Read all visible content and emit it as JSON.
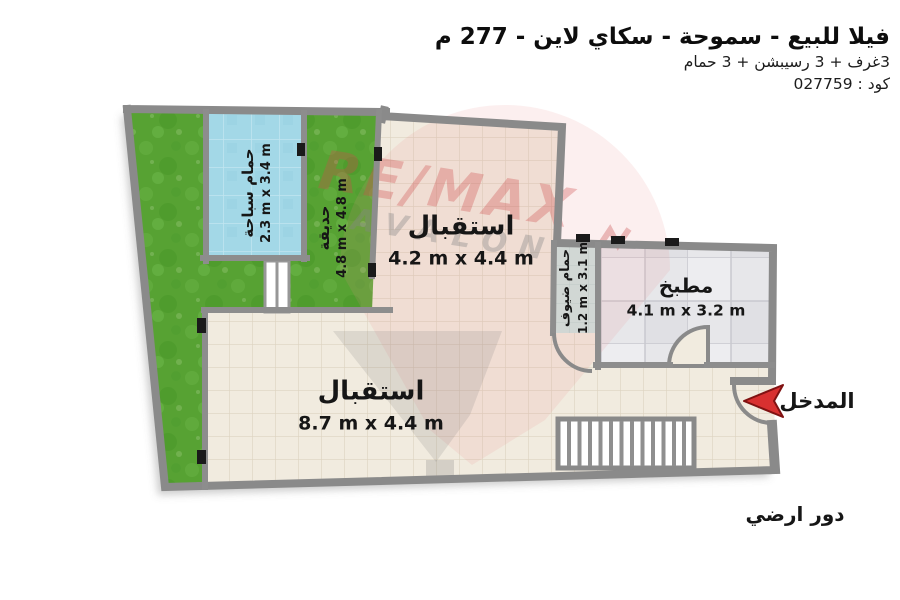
{
  "header": {
    "title": "فيلا للبيع - سموحة - سكاي لاين - 277 م",
    "subtitle": "3غرف + 3 رسيبشن + 3 حمام",
    "code": "كود : 027759"
  },
  "rooms": {
    "pool": {
      "name": "حمام سباحة",
      "dims": "2.3 m x 3.4 m"
    },
    "garden": {
      "name": "حديقة",
      "dims": "4.8 m x 4.8 m"
    },
    "reception_top": {
      "name": "استقبال",
      "dims": "4.2 m x 4.4 m"
    },
    "guest_bath": {
      "name": "حمام ضيوف",
      "dims": "1.2 m x 3.1 m"
    },
    "kitchen": {
      "name": "مطبخ",
      "dims": "4.1 m x 3.2 m"
    },
    "reception_main": {
      "name": "استقبال",
      "dims": "8.7 m x 4.4 m"
    }
  },
  "entrance_label": "المدخل",
  "floor_label": "دور ارضي",
  "watermark": {
    "line1": "RE/MAX",
    "line2": "AVALON"
  },
  "colors": {
    "grass": "#57a233",
    "pool_water": "#a3d8e7",
    "wall_gray": "#8a8a8a",
    "floor_beige": "#f1ebdf",
    "kitchen_floor": "#e7e7ea",
    "bath_floor": "#cde4e0",
    "entrance_arrow": "#d83030"
  }
}
